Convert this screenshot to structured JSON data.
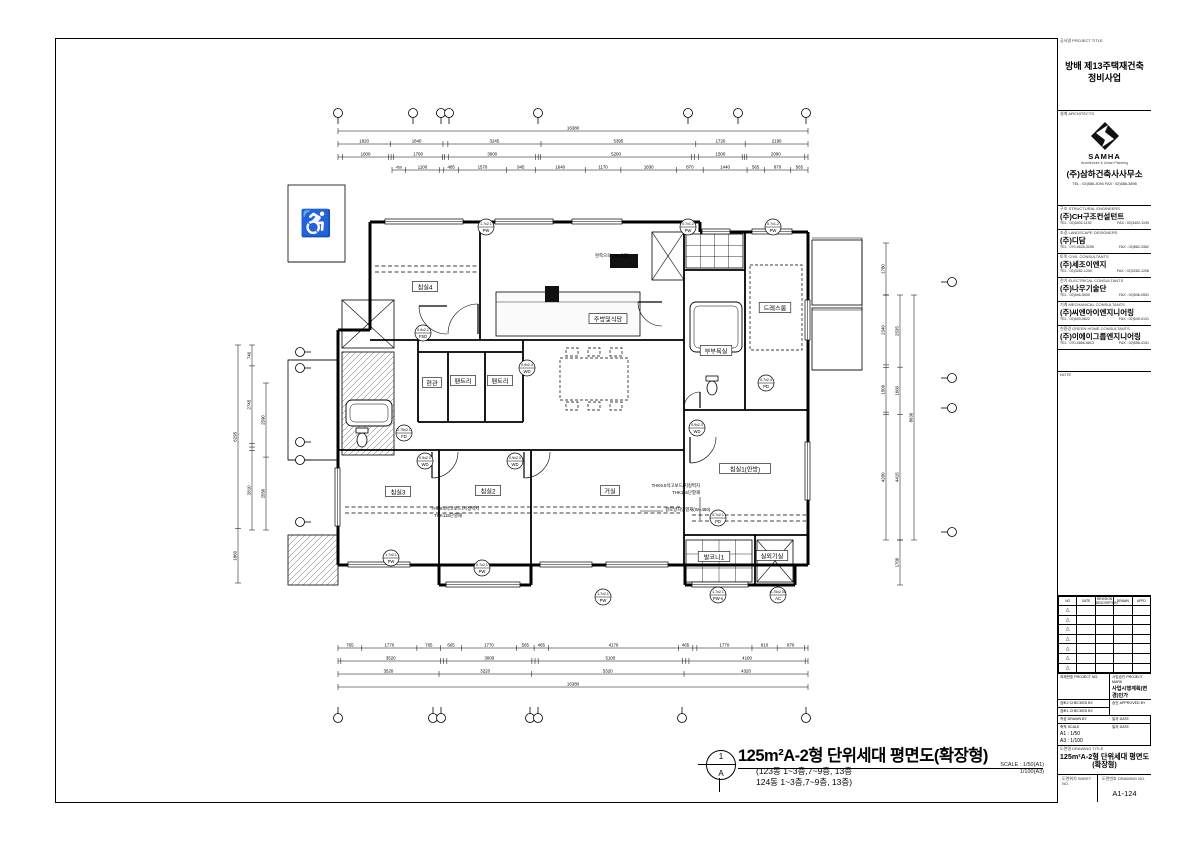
{
  "project": {
    "title_header": "공사명 PROJECT TITLE",
    "title": "방배 제13주택재건축\n정비사업"
  },
  "architects": {
    "header": "설계 ARCHITECTS",
    "logo": "samha-logo",
    "brand": "SAMHA",
    "brand_sub": "Architecture & Urban Planning",
    "name": "(주)삼하건축사사무소",
    "tel": "TEL : 02)586-3094   FAX : 02)586-3898"
  },
  "companies": [
    {
      "header": "구조 STRUCTURAL ENGINEERS",
      "name": "(주)CH구조컨설턴트",
      "tel": "TEL : 02)3402-1192",
      "fax": "FAX : 02)3402-1195"
    },
    {
      "header": "조경 LANDSCAPE DESIGNERS",
      "name": "(주)디담",
      "tel": "TEL : 070-4628-3206",
      "fax": "FAX : 02)862-3362"
    },
    {
      "header": "토목 CIVIL CONSULTANTS",
      "name": "(주)세조이엔지",
      "tel": "TEL : 02)3282-1200",
      "fax": "FAX : 02)3282-1206"
    },
    {
      "header": "전기 ELECTRICAL CONSULTANTS",
      "name": "(주)나우기술단",
      "tel": "TEL : 02)546-0530",
      "fax": "FAX : 02)546-0551"
    },
    {
      "header": "기계 MECHANICAL CONSULTANTS",
      "name": "(주)씨엔아이엔지니어링",
      "tel": "TEL : 02)549-0622",
      "fax": "FAX : 02)549-0101"
    },
    {
      "header": "친환경 GREEN HOME CONSULTANTS",
      "name": "(주)이에이그룹엔지니어링",
      "tel": "TEL : 070-4666-6813",
      "fax": "FAX : 02)558-4151"
    }
  ],
  "note": {
    "header": "NOTE"
  },
  "revisions": {
    "headers": [
      "NO",
      "DATE",
      "REVISION DESCRIPTION",
      "DRAWN",
      "APPD"
    ],
    "row_count": 7,
    "marker": "△"
  },
  "approval": {
    "project_no_label": "과제번호 PROJECT NO.",
    "permit_label": "사업승인 PROJECT MARK",
    "permit": "사업시행계획(변경)인가",
    "checked2_label": "검토2 CHECKED BY",
    "approved_label": "승인 APPROVED BY",
    "checked1_label": "검토1 CHECKED BY",
    "drawn_label": "작성 DRAWN BY",
    "scale_label": "축척 SCALE",
    "scale_a1": "A1 : 1/50",
    "scale_a3": "A3 : 1/100",
    "date_label": "일자 DATE"
  },
  "drawing": {
    "title_header": "도면명 DRAWING TITLE",
    "title_line1": "125m²A-2형 단위세대 평면도",
    "title_line2": "(확장형)",
    "sheet_no_header": "도면위치 SHEET NO.",
    "no_header": "도면번호 DRAWING NO.",
    "no": "A1-124"
  },
  "footer": {
    "circle_top": "1",
    "circle_bottom": "A",
    "title": "125m²A-2형 단위세대 평면도(확장형)",
    "sub1": "(123동 1~3층,7~9층, 13층",
    "sub2": "124동 1~3층,7~9층, 13층)",
    "scale1": "SCALE : 1/50(A1)",
    "scale2": "1/100(A3)"
  },
  "plan": {
    "rooms": [
      {
        "label": "침실4",
        "x": 425,
        "y": 287
      },
      {
        "label": "주방및식당",
        "x": 608,
        "y": 319
      },
      {
        "label": "현관",
        "x": 432,
        "y": 383
      },
      {
        "label": "팬트리",
        "x": 463,
        "y": 381
      },
      {
        "label": "팬트리",
        "x": 500,
        "y": 381
      },
      {
        "label": "드레스룸",
        "x": 775,
        "y": 308
      },
      {
        "label": "부부욕실",
        "x": 716,
        "y": 351
      },
      {
        "label": "침실3",
        "x": 398,
        "y": 492
      },
      {
        "label": "침실2",
        "x": 488,
        "y": 491
      },
      {
        "label": "거실",
        "x": 610,
        "y": 491
      },
      {
        "label": "침실1(안방)",
        "x": 745,
        "y": 469
      },
      {
        "label": "발코니1",
        "x": 714,
        "y": 557
      },
      {
        "label": "실외기실",
        "x": 772,
        "y": 556
      }
    ],
    "notes": [
      {
        "text": "왼쪽으로 250 이동",
        "x": 612,
        "y": 257,
        "anchor": "middle"
      },
      {
        "text": "THK9.5석고보드/지정벽지",
        "x": 700,
        "y": 487,
        "anchor": "end"
      },
      {
        "text": "THK115단열재",
        "x": 700,
        "y": 494,
        "anchor": "end"
      },
      {
        "text": "결로방지단열재(W=450)",
        "x": 665,
        "y": 511,
        "anchor": "start"
      },
      {
        "text": "THK9.5석고보드/지정벽지",
        "x": 455,
        "y": 510,
        "anchor": "middle"
      },
      {
        "text": "THK115단열재",
        "x": 448,
        "y": 517,
        "anchor": "middle"
      }
    ],
    "tags": [
      {
        "code": "1.7x2.1",
        "type": "PW",
        "x": 486,
        "y": 227
      },
      {
        "code": "0.7x1.2",
        "type": "PW",
        "x": 688,
        "y": 227
      },
      {
        "code": "0.7x1.2",
        "type": "PW",
        "x": 773,
        "y": 227
      },
      {
        "code": "0.9x2.1",
        "type": "FSD",
        "x": 423,
        "y": 333
      },
      {
        "code": "0.9x2.4",
        "type": "WD",
        "x": 527,
        "y": 368
      },
      {
        "code": "0.7x2.4",
        "type": "PD",
        "x": 766,
        "y": 383
      },
      {
        "code": "0.75x2.1",
        "type": "FD",
        "x": 404,
        "y": 433
      },
      {
        "code": "0.9x2.3",
        "type": "WD",
        "x": 425,
        "y": 461
      },
      {
        "code": "0.9x2.3",
        "type": "WD",
        "x": 515,
        "y": 461
      },
      {
        "code": "0.9x2.3",
        "type": "WD",
        "x": 697,
        "y": 428
      },
      {
        "code": "0.7x2.1",
        "type": "PD",
        "x": 718,
        "y": 518
      },
      {
        "code": "1.7x2.1",
        "type": "PW",
        "x": 391,
        "y": 558
      },
      {
        "code": "0.7x2.1",
        "type": "PW",
        "x": 482,
        "y": 568
      },
      {
        "code": "1.7x2.1",
        "type": "PW",
        "x": 603,
        "y": 597
      },
      {
        "code": "1.7x2.1",
        "type": "PW-s",
        "x": 718,
        "y": 595
      },
      {
        "code": "0.75x2.05",
        "type": "AC",
        "x": 778,
        "y": 595
      }
    ],
    "walls": [
      [
        370,
        222,
        700,
        222
      ],
      [
        370,
        222,
        370,
        330
      ],
      [
        338,
        330,
        370,
        330
      ],
      [
        338,
        330,
        338,
        565
      ],
      [
        700,
        222,
        700,
        232
      ],
      [
        700,
        232,
        808,
        232
      ],
      [
        808,
        232,
        808,
        565
      ],
      [
        338,
        565,
        808,
        565
      ],
      [
        439,
        565,
        439,
        585
      ],
      [
        439,
        585,
        531,
        585
      ],
      [
        531,
        565,
        531,
        585
      ],
      [
        685,
        565,
        685,
        585
      ],
      [
        685,
        585,
        795,
        585
      ],
      [
        795,
        565,
        795,
        585
      ]
    ],
    "interior": [
      [
        480,
        222,
        480,
        340
      ],
      [
        370,
        340,
        684,
        340
      ],
      [
        338,
        450,
        684,
        450
      ],
      [
        439,
        450,
        439,
        565
      ],
      [
        531,
        450,
        531,
        565
      ],
      [
        684,
        232,
        684,
        565
      ],
      [
        684,
        410,
        808,
        410
      ],
      [
        684,
        535,
        808,
        535
      ],
      [
        745,
        232,
        745,
        410
      ],
      [
        684,
        270,
        745,
        270
      ],
      [
        755,
        535,
        755,
        585
      ],
      [
        418,
        340,
        418,
        422
      ],
      [
        523,
        340,
        523,
        422
      ],
      [
        418,
        422,
        523,
        422
      ],
      [
        448,
        352,
        448,
        422
      ],
      [
        485,
        352,
        485,
        422
      ],
      [
        418,
        352,
        523,
        352
      ]
    ],
    "thin": [
      [
        700,
        497,
        700,
        520
      ],
      [
        640,
        511,
        663,
        511
      ],
      [
        288,
        360,
        338,
        360
      ],
      [
        288,
        460,
        338,
        460
      ],
      [
        288,
        262,
        345,
        262
      ],
      [
        812,
        238,
        862,
        238
      ],
      [
        862,
        238,
        862,
        310
      ],
      [
        812,
        310,
        862,
        310
      ],
      [
        812,
        370,
        862,
        370
      ]
    ],
    "dashed": [
      [
        345,
        507,
        680,
        507
      ],
      [
        345,
        513,
        680,
        513
      ],
      [
        692,
        515,
        806,
        515
      ],
      [
        692,
        521,
        806,
        521
      ],
      [
        375,
        266,
        478,
        266
      ],
      [
        375,
        272,
        478,
        272
      ]
    ],
    "boxes": [
      {
        "x": 288,
        "y": 185,
        "w": 57,
        "h": 77,
        "s": "plain"
      },
      {
        "x": 342,
        "y": 300,
        "w": 52,
        "h": 48,
        "s": "x"
      },
      {
        "x": 342,
        "y": 352,
        "w": 52,
        "h": 103,
        "s": "hatch"
      },
      {
        "x": 346,
        "y": 400,
        "w": 46,
        "h": 26,
        "s": "tub"
      },
      {
        "x": 288,
        "y": 360,
        "w": 50,
        "h": 100,
        "s": "plain"
      },
      {
        "x": 288,
        "y": 535,
        "w": 50,
        "h": 50,
        "s": "hatch"
      },
      {
        "x": 496,
        "y": 292,
        "w": 144,
        "h": 44,
        "s": "counter"
      },
      {
        "x": 610,
        "y": 254,
        "w": 28,
        "h": 14,
        "s": "black"
      },
      {
        "x": 545,
        "y": 286,
        "w": 14,
        "h": 16,
        "s": "black"
      },
      {
        "x": 560,
        "y": 358,
        "w": 68,
        "h": 42,
        "s": "dashedbox"
      },
      {
        "x": 566,
        "y": 348,
        "w": 12,
        "h": 8,
        "s": "dashedbox"
      },
      {
        "x": 588,
        "y": 348,
        "w": 12,
        "h": 8,
        "s": "dashedbox"
      },
      {
        "x": 610,
        "y": 348,
        "w": 12,
        "h": 8,
        "s": "dashedbox"
      },
      {
        "x": 566,
        "y": 402,
        "w": 12,
        "h": 8,
        "s": "dashedbox"
      },
      {
        "x": 588,
        "y": 402,
        "w": 12,
        "h": 8,
        "s": "dashedbox"
      },
      {
        "x": 610,
        "y": 402,
        "w": 12,
        "h": 8,
        "s": "dashedbox"
      },
      {
        "x": 652,
        "y": 232,
        "w": 32,
        "h": 48,
        "s": "x"
      },
      {
        "x": 686,
        "y": 234,
        "w": 57,
        "h": 34,
        "s": "grid"
      },
      {
        "x": 690,
        "y": 302,
        "w": 52,
        "h": 50,
        "s": "tub"
      },
      {
        "x": 750,
        "y": 265,
        "w": 52,
        "h": 85,
        "s": "dashedbox"
      },
      {
        "x": 757,
        "y": 540,
        "w": 36,
        "h": 42,
        "s": "x"
      },
      {
        "x": 686,
        "y": 540,
        "w": 66,
        "h": 42,
        "s": "grid"
      },
      {
        "x": 812,
        "y": 240,
        "w": 50,
        "h": 65,
        "s": "plain"
      },
      {
        "x": 812,
        "y": 308,
        "w": 50,
        "h": 62,
        "s": "plain"
      }
    ],
    "toilets": [
      {
        "x": 712,
        "y": 388
      },
      {
        "x": 362,
        "y": 440
      }
    ],
    "glyphs": [
      {
        "char": "♿",
        "x": 316,
        "y": 232,
        "size": 26
      }
    ],
    "arcs": [
      {
        "cx": 478,
        "cy": 334,
        "r": 30,
        "a0": 180,
        "a1": 270
      },
      {
        "cx": 447,
        "cy": 306,
        "r": 28,
        "a0": 90,
        "a1": 180
      },
      {
        "cx": 432,
        "cy": 452,
        "r": 26,
        "a0": 0,
        "a1": 90
      },
      {
        "cx": 524,
        "cy": 452,
        "r": 26,
        "a0": 0,
        "a1": 90
      },
      {
        "cx": 690,
        "cy": 437,
        "r": 26,
        "a0": 0,
        "a1": 90
      },
      {
        "cx": 700,
        "cy": 408,
        "r": 16,
        "a0": 180,
        "a1": 270
      },
      {
        "cx": 662,
        "cy": 302,
        "r": 24,
        "a0": 90,
        "a1": 180
      }
    ],
    "windows": [
      [
        385,
        219,
        78,
        5
      ],
      [
        495,
        219,
        58,
        5
      ],
      [
        572,
        219,
        50,
        5
      ],
      [
        702,
        229,
        28,
        5
      ],
      [
        752,
        229,
        40,
        5
      ],
      [
        348,
        562,
        62,
        5
      ],
      [
        446,
        582,
        74,
        5
      ],
      [
        540,
        562,
        52,
        5
      ],
      [
        606,
        562,
        62,
        5
      ],
      [
        692,
        582,
        56,
        5
      ],
      [
        335,
        468,
        5,
        58
      ],
      [
        805,
        442,
        5,
        58
      ],
      [
        805,
        300,
        5,
        40
      ]
    ],
    "grids": {
      "top": {
        "y": 113,
        "xs": [
          338,
          413,
          441,
          449,
          538,
          688,
          738,
          806
        ]
      },
      "bottom": {
        "y": 718,
        "xs": [
          338,
          433,
          441,
          530,
          538,
          682,
          806
        ]
      },
      "left": {
        "x": 300,
        "ys": [
          352,
          368,
          442,
          460,
          522
        ]
      },
      "right": {
        "x": 952,
        "ys": [
          282,
          378,
          408,
          532
        ]
      }
    },
    "dims": [
      {
        "dir": "h",
        "y": 131,
        "x0": 338,
        "x1": 808,
        "values": [
          16380
        ]
      },
      {
        "dir": "h",
        "y": 144,
        "x0": 338,
        "x1": 808,
        "values": [
          1820,
          1840,
          170,
          3245,
          5395,
          1720,
          2190
        ]
      },
      {
        "dir": "h",
        "y": 157,
        "x0": 338,
        "x1": 808,
        "values": [
          150,
          1600,
          80,
          80,
          1700,
          60,
          150,
          3000,
          85,
          85,
          5200,
          110,
          140,
          1500,
          80,
          80,
          2000,
          110
        ]
      },
      {
        "dir": "h",
        "y": 170,
        "x0": 392,
        "x1": 808,
        "values": [
          450,
          1100,
          150,
          485,
          1570,
          945,
          1640,
          1170,
          1830,
          870,
          1440,
          565,
          870,
          565
        ]
      },
      {
        "dir": "h",
        "y": 648,
        "x0": 338,
        "x1": 808,
        "values": [
          765,
          1770,
          765,
          665,
          1770,
          565,
          465,
          4170,
          465,
          130,
          1770,
          810,
          870,
          120
        ]
      },
      {
        "dir": "h",
        "y": 661,
        "x0": 338,
        "x1": 808,
        "values": [
          100,
          3520,
          110,
          110,
          3000,
          110,
          110,
          5100,
          110,
          110,
          4100,
          100
        ]
      },
      {
        "dir": "h",
        "y": 674,
        "x0": 338,
        "x1": 808,
        "values": [
          3520,
          3220,
          5320,
          4320
        ]
      },
      {
        "dir": "h",
        "y": 687,
        "x0": 338,
        "x1": 808,
        "values": [
          16380
        ]
      },
      {
        "dir": "v",
        "x": 238,
        "y0": 345,
        "y1": 583,
        "values": [
          6295,
          1860
        ]
      },
      {
        "dir": "v",
        "x": 252,
        "y0": 345,
        "y1": 530,
        "values": [
          740,
          2745,
          125,
          125,
          2810
        ]
      },
      {
        "dir": "v",
        "x": 266,
        "y0": 383,
        "y1": 530,
        "values": [
          2590,
          2550
        ]
      },
      {
        "dir": "v",
        "x": 886,
        "y0": 243,
        "y1": 295,
        "values": [
          1780
        ]
      },
      {
        "dir": "v",
        "x": 886,
        "y0": 295,
        "y1": 540,
        "values": [
          2340,
          80,
          1500,
          80,
          4200
        ]
      },
      {
        "dir": "v",
        "x": 900,
        "y0": 295,
        "y1": 540,
        "values": [
          2535,
          1660,
          4415
        ]
      },
      {
        "dir": "v",
        "x": 914,
        "y0": 295,
        "y1": 540,
        "values": [
          8630
        ]
      },
      {
        "dir": "v",
        "x": 900,
        "y0": 540,
        "y1": 585,
        "values": [
          1700
        ]
      }
    ]
  }
}
